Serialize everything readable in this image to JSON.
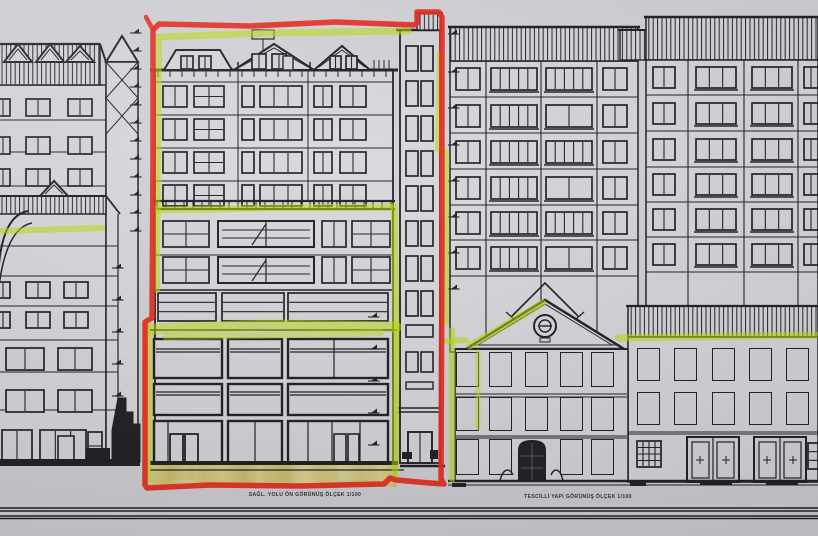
{
  "drawing": {
    "kind_label": "architectural elevation drawing (photograph)",
    "captions": {
      "left": "SAĞL. YOLU ÖN GÖRÜNÜŞ ÖLÇEK 1/100",
      "right": "TESCİLLİ YAPI GÖRÜNÜŞ ÖLÇEK 1/100"
    },
    "annotations": {
      "marker_red": "#e8281d",
      "highlighter_green": "#b7e000",
      "pencil_yellow": "#d9cb6a"
    },
    "palette": {
      "paper": "#d2d1d5",
      "facade": "#d9d8dc",
      "glass": "#d7d6da",
      "ink": "#1e1e22"
    }
  }
}
